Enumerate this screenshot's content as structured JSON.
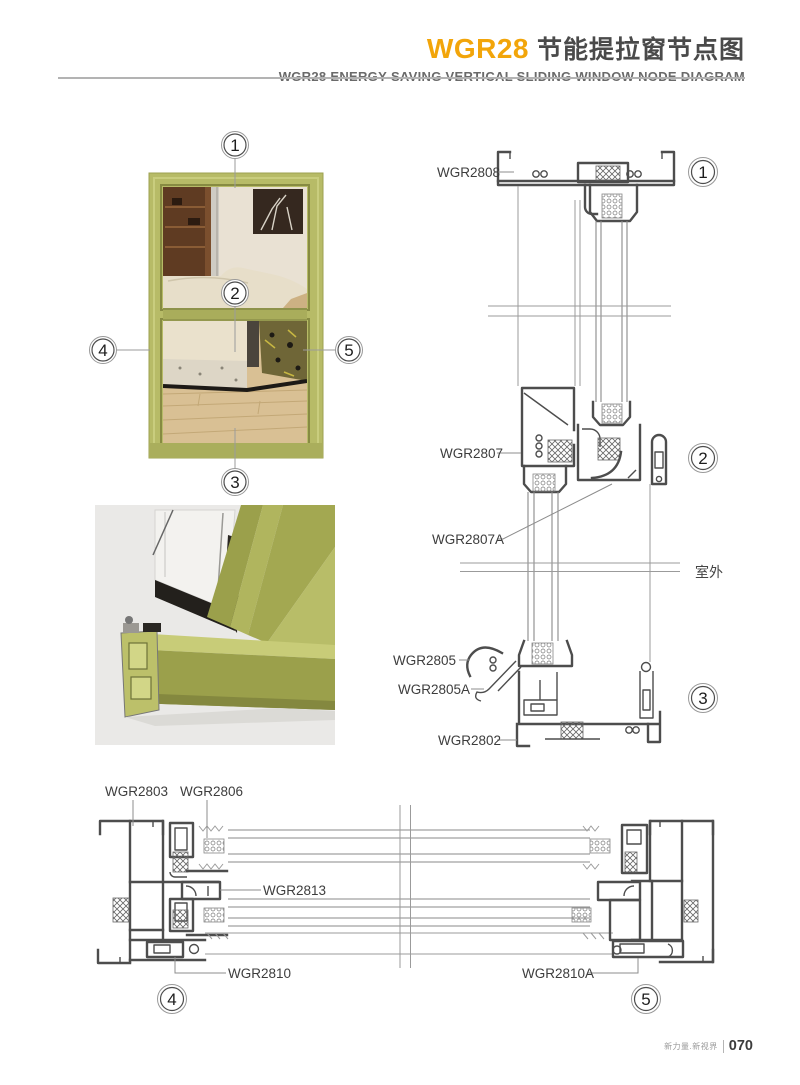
{
  "header": {
    "brand": "WGR28",
    "title_cn": "节能提拉窗节点图",
    "subtitle_en": "WGR28 ENERGY-SAVING VERTICAL SLIDING WINDOW NODE DIAGRAM",
    "accent_color": "#F2A50A"
  },
  "window_figure": {
    "frame_color": "#b7bb67",
    "callouts": [
      "1",
      "2",
      "3",
      "4",
      "5"
    ]
  },
  "vertical_section": {
    "labels": [
      "WGR2808",
      "WGR2807",
      "WGR2807A",
      "WGR2805",
      "WGR2805A",
      "WGR2802"
    ],
    "details": [
      "1",
      "2",
      "3"
    ],
    "outdoor_label": "室外"
  },
  "horizontal_section": {
    "labels": [
      "WGR2803",
      "WGR2806",
      "WGR2813",
      "WGR2810",
      "WGR2810A"
    ],
    "details": [
      "4",
      "5"
    ]
  },
  "footer": {
    "slogan": "新力量.新视界",
    "page_number": "070"
  }
}
